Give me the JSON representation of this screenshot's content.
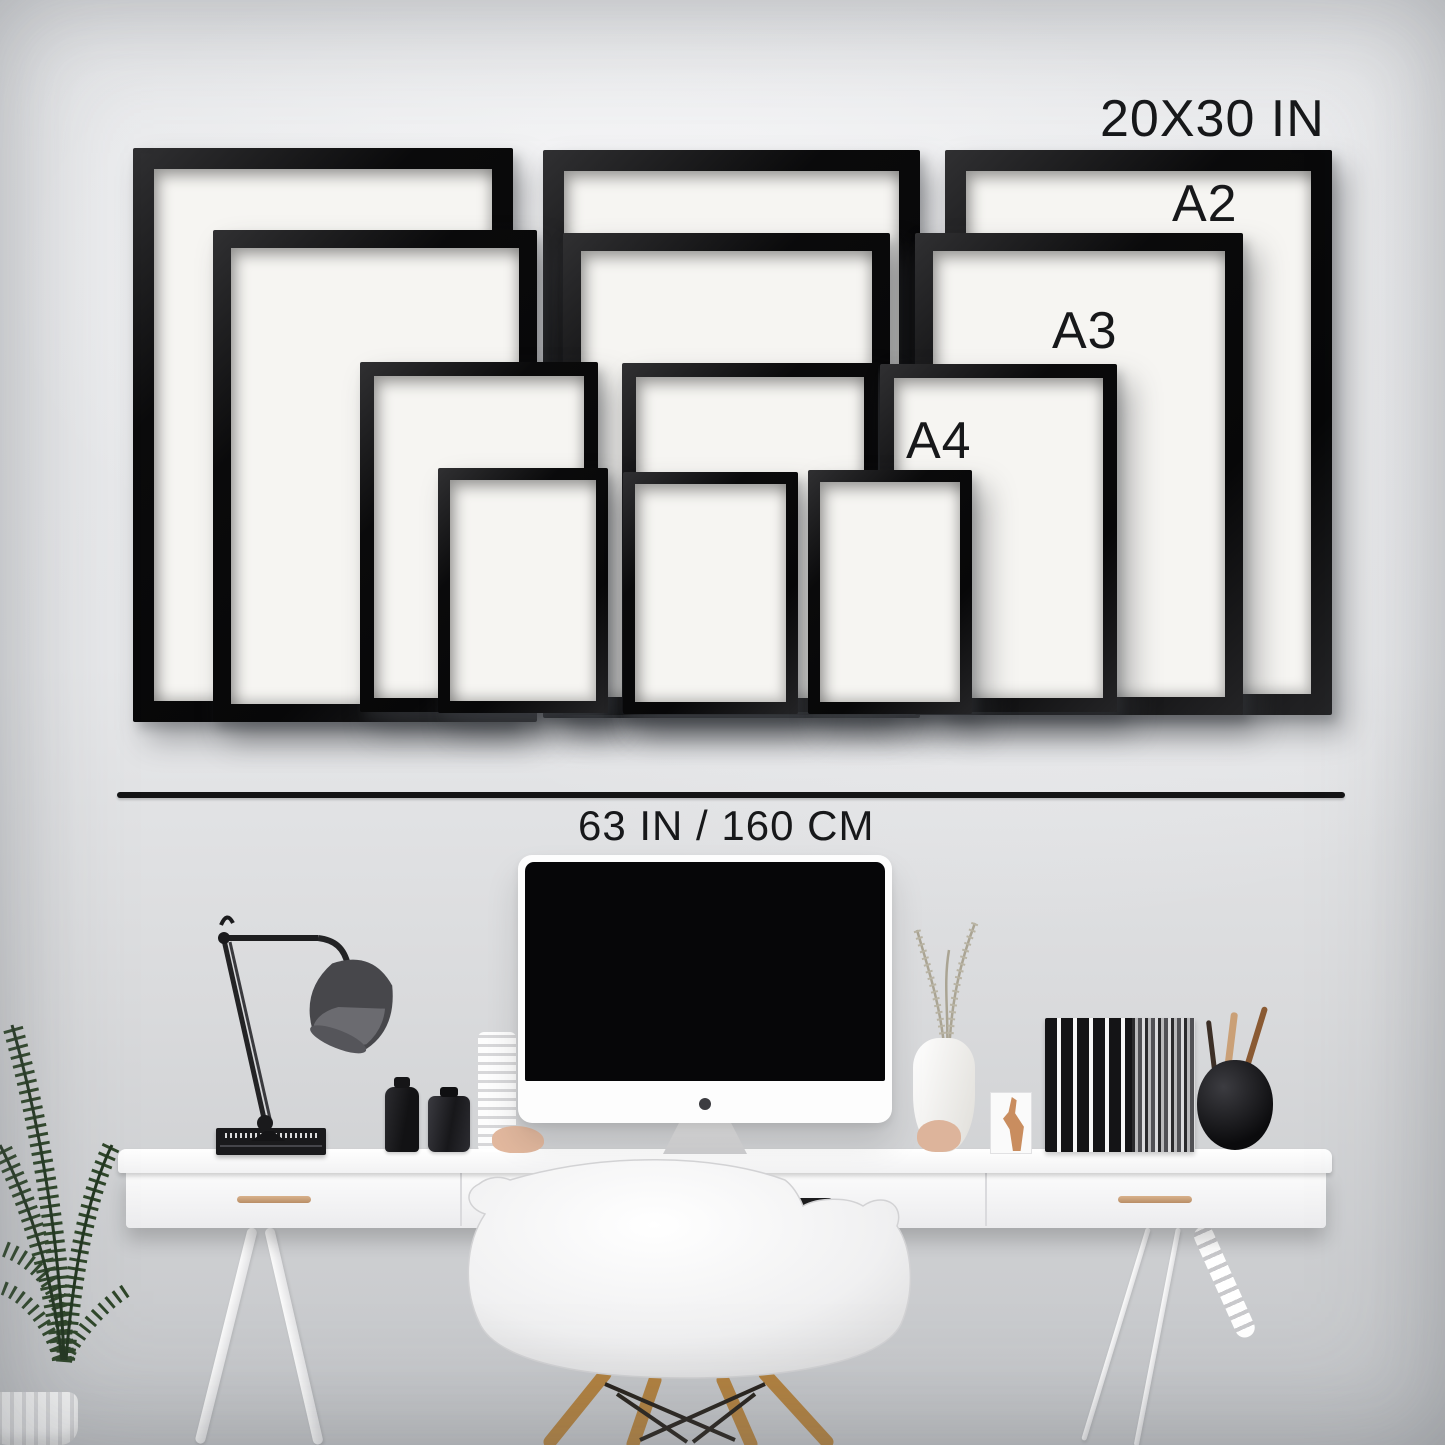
{
  "size_guide": {
    "frame_color": "#0e0e0f",
    "mat_color": "#f6f5f2",
    "text_color": "#17181a",
    "size_labels": [
      {
        "id": "20x30",
        "text": "20X30 IN"
      },
      {
        "id": "a2",
        "text": "A2"
      },
      {
        "id": "a3",
        "text": "A3"
      },
      {
        "id": "a4",
        "text": "A4"
      }
    ],
    "wall_width_label": "63 IN / 160 CM",
    "frames": [
      {
        "size": "20x30",
        "x": 133,
        "y": 148,
        "w": 380,
        "h": 574,
        "t": 21
      },
      {
        "size": "20x30",
        "x": 543,
        "y": 150,
        "w": 377,
        "h": 568,
        "t": 21
      },
      {
        "size": "20x30",
        "x": 945,
        "y": 150,
        "w": 387,
        "h": 565,
        "t": 21
      },
      {
        "size": "a2",
        "x": 213,
        "y": 230,
        "w": 324,
        "h": 492,
        "t": 18
      },
      {
        "size": "a2",
        "x": 563,
        "y": 233,
        "w": 327,
        "h": 482,
        "t": 18
      },
      {
        "size": "a2",
        "x": 915,
        "y": 233,
        "w": 328,
        "h": 482,
        "t": 18
      },
      {
        "size": "a3",
        "x": 360,
        "y": 362,
        "w": 238,
        "h": 350,
        "t": 14
      },
      {
        "size": "a3",
        "x": 622,
        "y": 363,
        "w": 256,
        "h": 349,
        "t": 14
      },
      {
        "size": "a3",
        "x": 880,
        "y": 364,
        "w": 237,
        "h": 348,
        "t": 14
      },
      {
        "size": "a4",
        "x": 438,
        "y": 468,
        "w": 170,
        "h": 245,
        "t": 12
      },
      {
        "size": "a4",
        "x": 623,
        "y": 472,
        "w": 175,
        "h": 242,
        "t": 12
      },
      {
        "size": "a4",
        "x": 808,
        "y": 470,
        "w": 164,
        "h": 244,
        "t": 12
      }
    ]
  },
  "scene": {
    "desk_color": "#fafafa",
    "wood_color": "#b3823f",
    "handle_color": "#c9a27e",
    "plant_color": "#2e4629",
    "objects": [
      "potted-palm-plant",
      "desk-lamp",
      "book-stack",
      "ink-bottles",
      "imac-computer",
      "white-vase-with-sprigs",
      "mini-frame-figurine",
      "standing-books",
      "pen-pot",
      "white-desk-with-drawers",
      "eames-armchair"
    ]
  }
}
